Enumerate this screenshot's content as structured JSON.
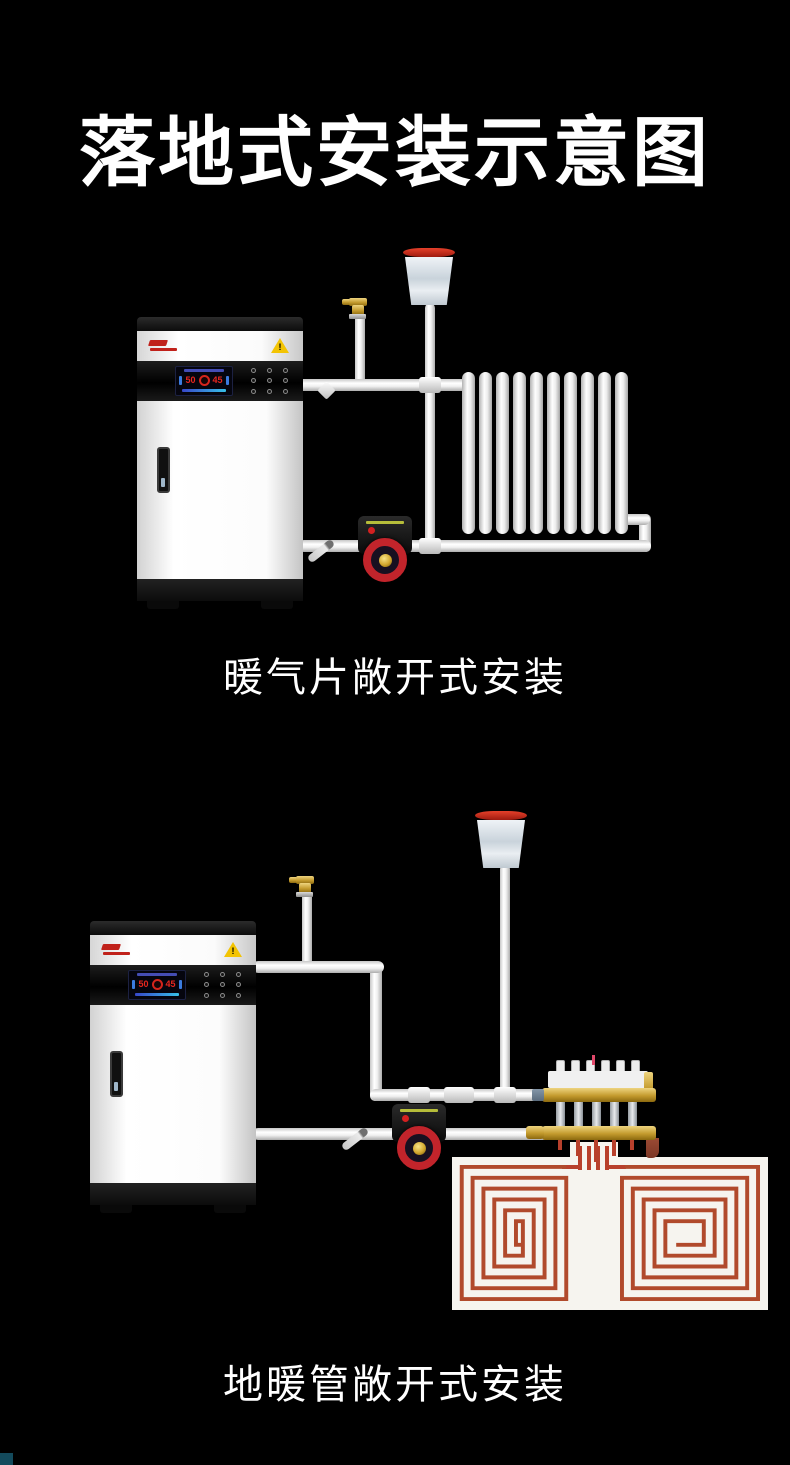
{
  "page": {
    "title": "落地式安装示意图",
    "background": "#000000"
  },
  "diagram1": {
    "caption": "暖气片敞开式安装"
  },
  "diagram2": {
    "caption": "地暖管敞开式安装"
  },
  "boiler": {
    "display": {
      "temp_left": "50",
      "temp_right": "45"
    },
    "warning_mark": "!"
  },
  "colors": {
    "pipe_white": "#f1f1f1",
    "pex_red": "#b14a2c",
    "pump_red": "#c2242b",
    "brass": "#c49b2e",
    "tank_rim_red": "#d5362a",
    "warning_yellow": "#f3c403",
    "display_temp_red": "#e8271e",
    "display_blue": "#3b55c9",
    "floor_panel_white": "#f6f4ef",
    "next_section_sliver": "#134a5c"
  }
}
